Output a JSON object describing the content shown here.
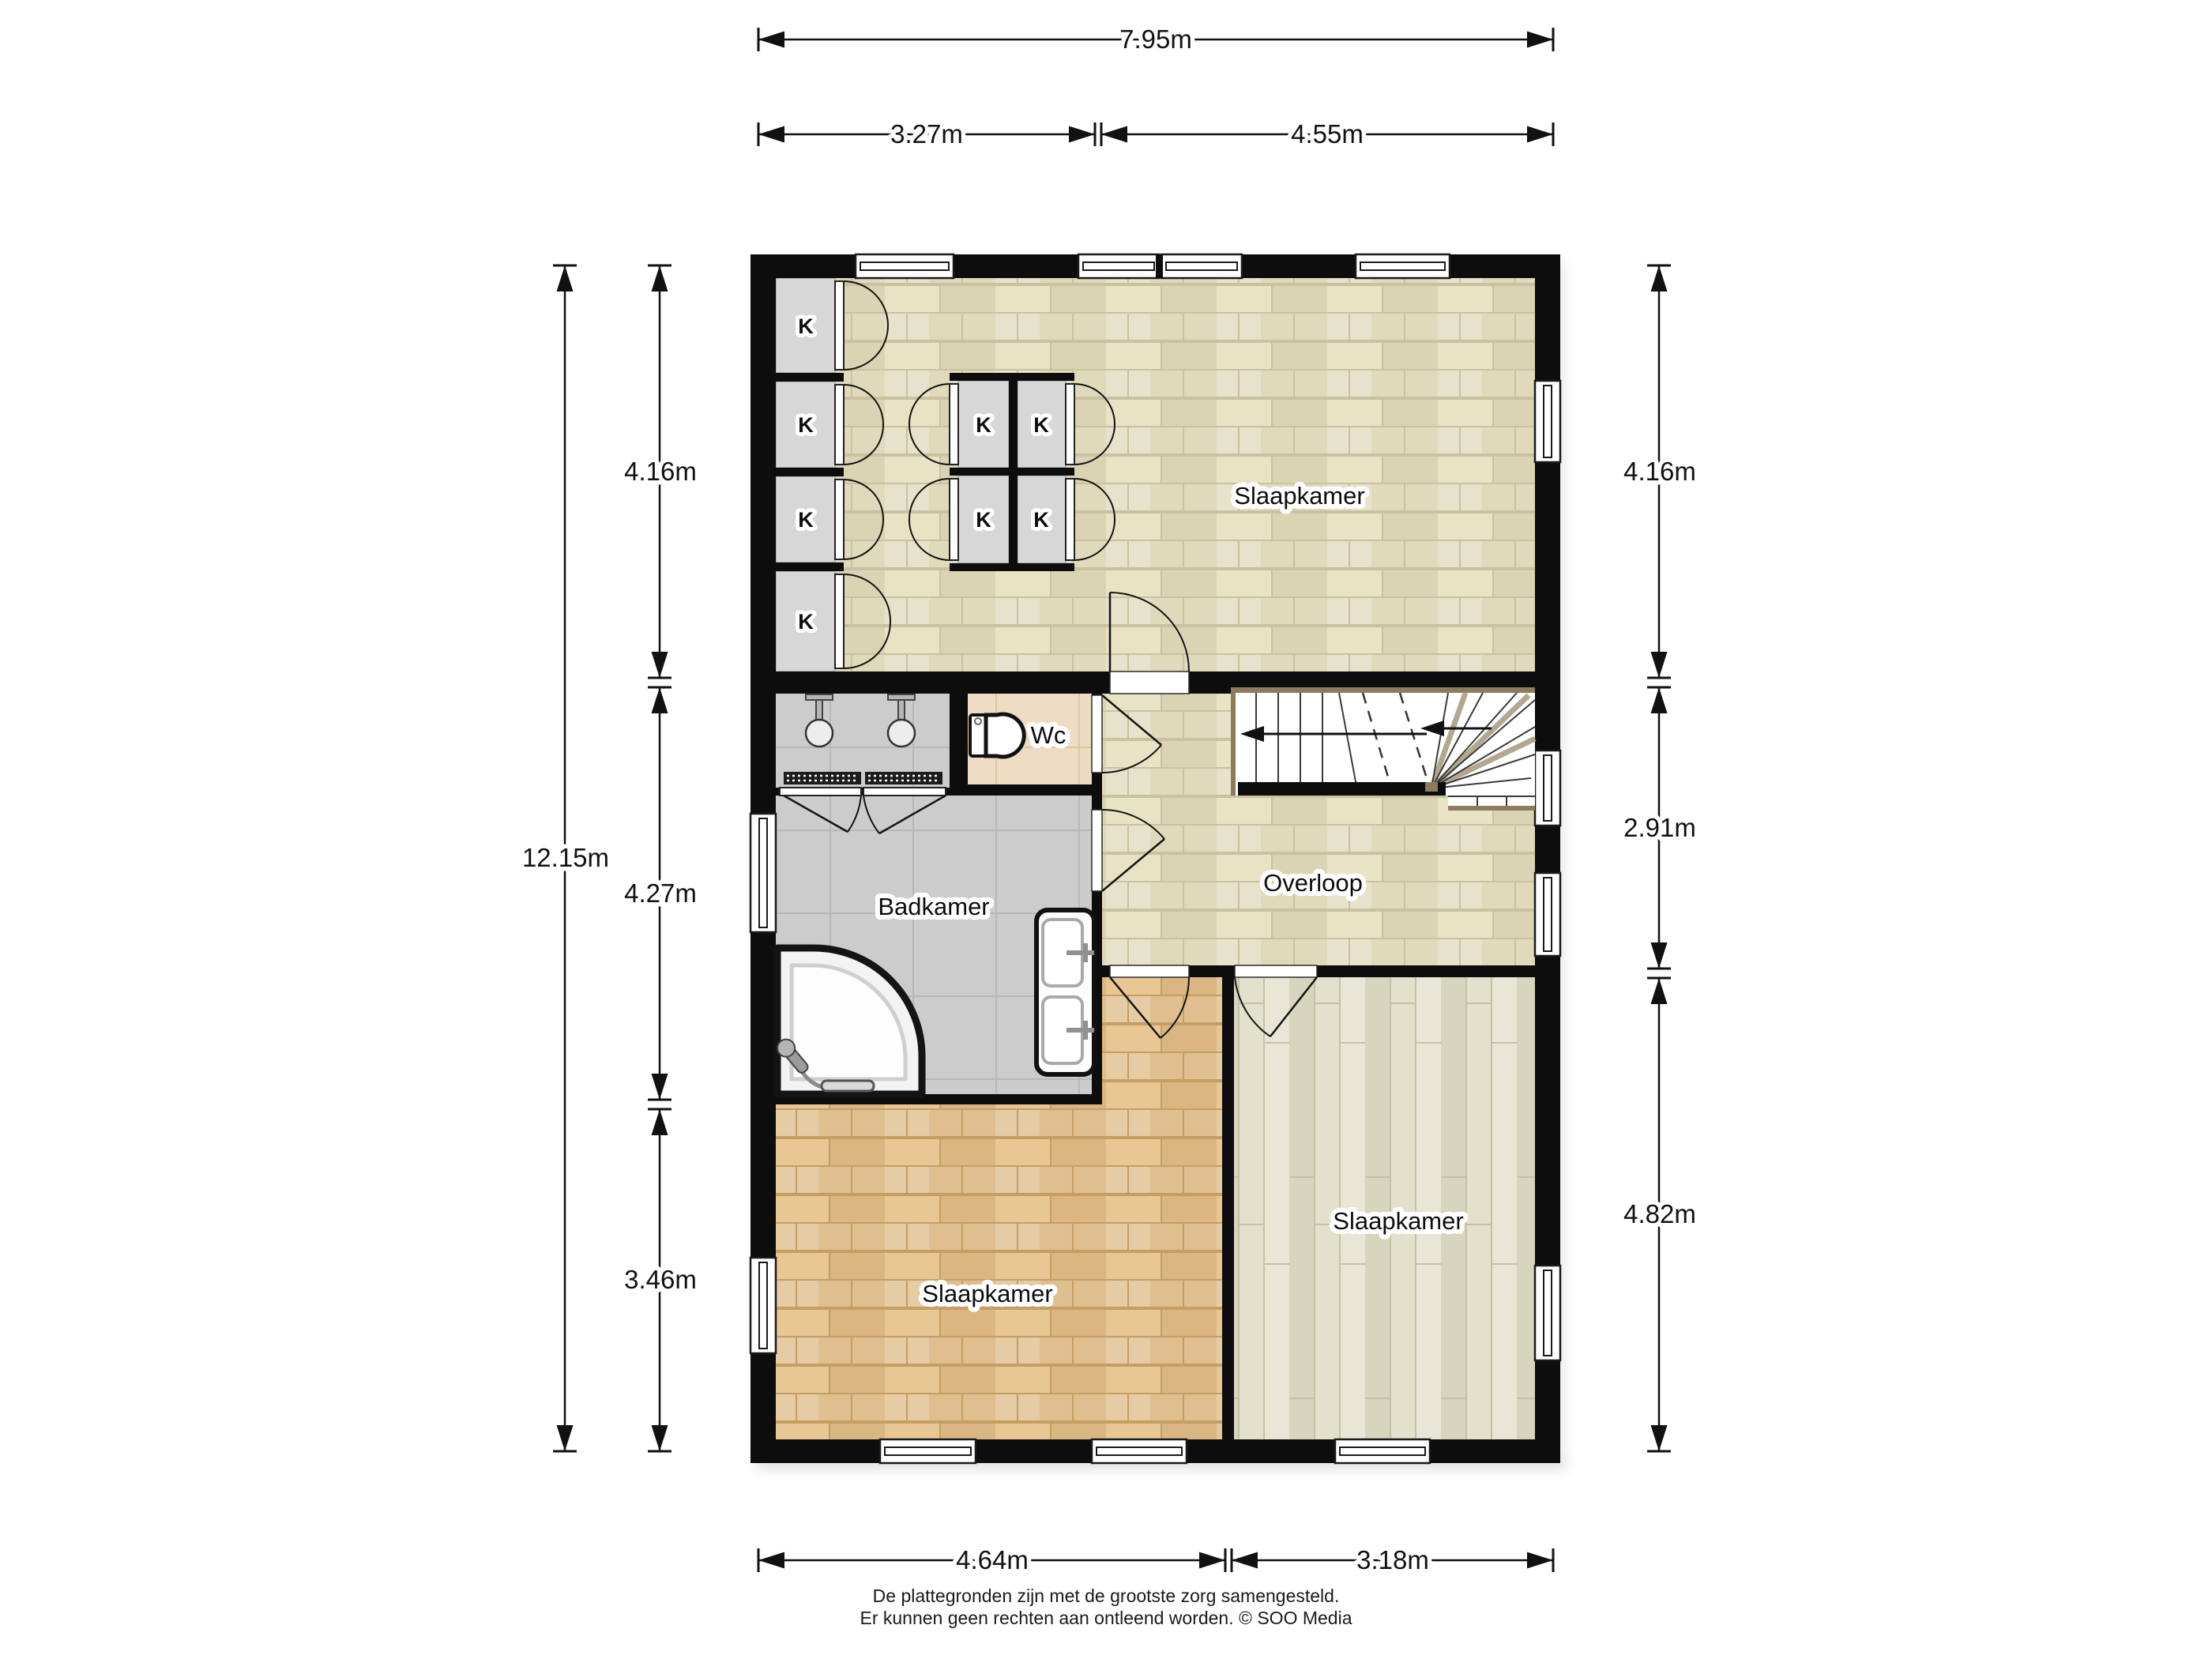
{
  "labels": {
    "bedroom_top": "Slaapkamer",
    "bedroom_bottom_left": "Slaapkamer",
    "bedroom_bottom_right": "Slaapkamer",
    "bathroom": "Badkamer",
    "toilet": "Wc",
    "landing": "Overloop",
    "closet": "K"
  },
  "dimensions": {
    "top_total": "7.95m",
    "top_left": "3.27m",
    "top_right": "4.55m",
    "left_total": "12.15m",
    "left_top": "4.16m",
    "left_middle": "4.27m",
    "left_bottom": "3.46m",
    "right_top": "4.16m",
    "right_middle": "2.91m",
    "right_bottom": "4.82m",
    "bottom_left": "4.64m",
    "bottom_right": "3.18m"
  },
  "footer": {
    "line1": "De plattegronden zijn met de grootste zorg samengesteld.",
    "line2": "Er kunnen geen rechten aan ontleend worden. © SOO Media"
  },
  "colors": {
    "wall": "#0d0d0d",
    "parquet_light": "#e9e3c5",
    "parquet_orange": "#e8c795",
    "planks_green": "#e2e1cb",
    "tile_grey": "#cccccc",
    "tile_beige": "#eddcc3",
    "closet_grey": "#d7d7d7",
    "stair_trim": "#8b7c5d"
  }
}
